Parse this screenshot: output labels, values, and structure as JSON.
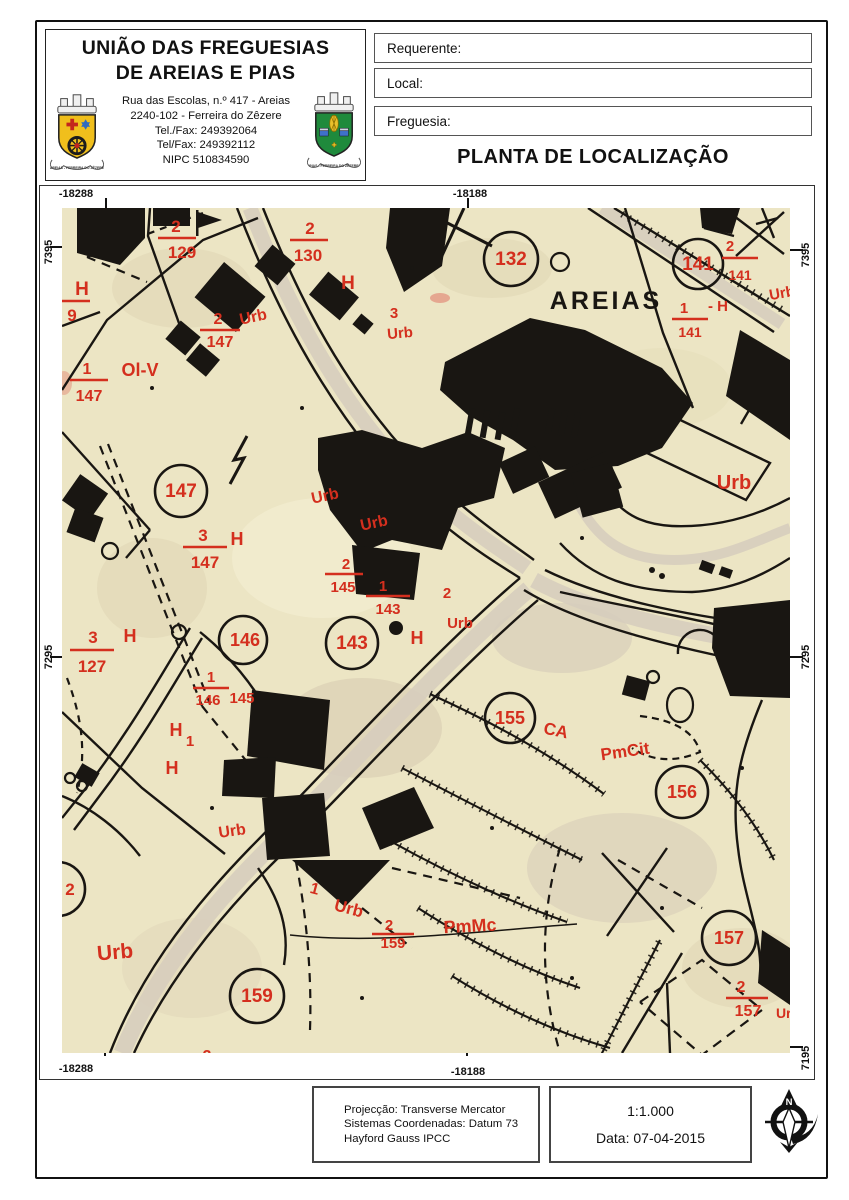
{
  "header": {
    "org_line1": "UNIÃO DAS FREGUESIAS",
    "org_line2": "DE AREIAS E PIAS",
    "address": [
      "Rua das Escolas, n.º 417 - Areias",
      "2240-102 - Ferreira do Zêzere",
      "Tel./Fax: 249392064",
      "Tel/Fax: 249392112",
      "NIPC 510834590"
    ],
    "crest_left_motto": "AREIAS - FERREIRA DO ZÊZERE",
    "crest_right_motto": "PIAS - FERREIRA DO ZÊZERE"
  },
  "form": {
    "field1": "Requerente:",
    "field2": "Local:",
    "field3": "Freguesia:",
    "title": "PLANTA DE LOCALIZAÇÃO"
  },
  "map": {
    "place": "AREIAS",
    "coordinates": {
      "top_left": "-18288",
      "top_center": "-18188",
      "bottom_left": "-18288",
      "bottom_center": "-18188",
      "left_upper": "7395",
      "left_lower": "7295",
      "right_upper": "7395",
      "right_middle": "7295",
      "right_lower": "7195"
    },
    "labels": [
      "2",
      "129",
      "H",
      "9",
      "2",
      "147",
      "Urb",
      "1",
      "147",
      "Ol-V",
      "2",
      "130",
      "H",
      "3",
      "Urb",
      "132",
      "141",
      "2",
      "141",
      "1",
      "- H",
      "141",
      "Urb",
      "Urb",
      "147",
      "3",
      "147",
      "H",
      "Urb",
      "Urb",
      "2",
      "145",
      "1",
      "143",
      "2",
      "Urb",
      "143",
      "H",
      "3",
      "127",
      "H",
      "146",
      "1",
      "146",
      "145",
      "H",
      "H",
      "Urb",
      "2",
      "Urb",
      "159",
      "1",
      "Urb",
      "2",
      "159",
      "PmMc",
      "155",
      "CA",
      "PmCit",
      "156",
      "157",
      "2",
      "157",
      "Urb",
      "2",
      "Urb",
      "1"
    ]
  },
  "footer": {
    "projection": [
      "Projecção: Transverse Mercator",
      "Sistemas Coordenadas: Datum 73",
      "Hayford Gauss IPCC"
    ],
    "scale": "1:1.000",
    "date": "Data: 07-04-2015",
    "north": "N"
  },
  "colors": {
    "map_bg": "#ece5c4",
    "ink": "#191612",
    "red": "#d42f1e",
    "shield_left": "#f0bf1c",
    "shield_right": "#1f8a3c"
  }
}
